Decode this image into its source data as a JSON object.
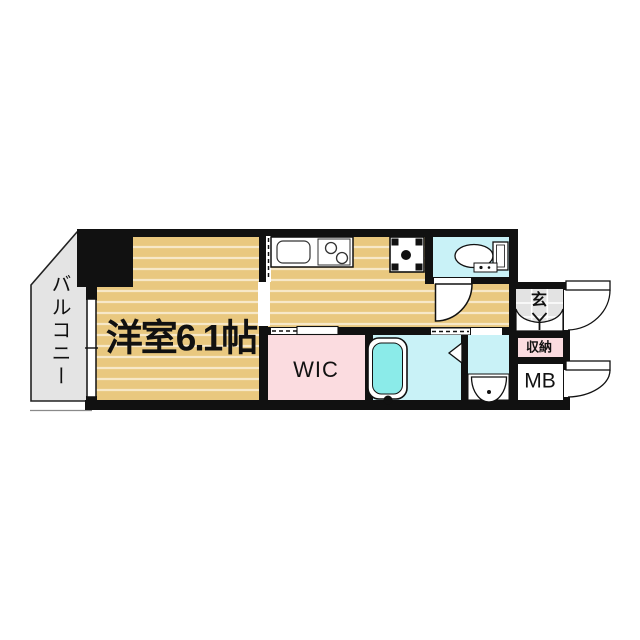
{
  "floor_plan": {
    "labels": {
      "main_room": "洋室6.1帖",
      "balcony": "バルコニー",
      "walk_in_closet": "WIC",
      "entrance": "玄",
      "storage": "収納",
      "meter_box": "MB"
    },
    "colors": {
      "wall": "#111111",
      "flooring": "#e9c87f",
      "flooring_stripe": "#f7e8c8",
      "balcony_gray": "#e4e4e4",
      "closet_pink": "#fbdce0",
      "wet_area_cyan": "#c9f2f7",
      "bath_water": "#8bebe9",
      "entrance_tile": "#e3e3e3"
    }
  }
}
